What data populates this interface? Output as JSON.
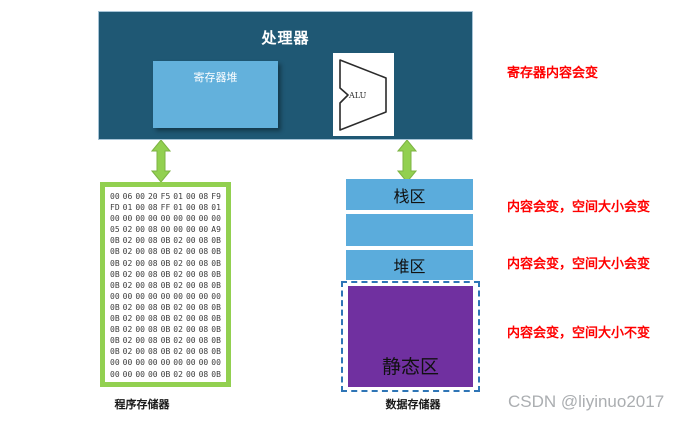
{
  "colors": {
    "processor_bg": "#1F5874",
    "register_bg": "#63B1DC",
    "memory_border_green": "#92D050",
    "arrow_green": "#92D050",
    "block_blue": "#5BACDC",
    "static_purple": "#7030A0",
    "dashed_border_blue": "#2E75B6",
    "annotation_red": "#FF0000",
    "watermark_gray": "#ABAEB1"
  },
  "processor": {
    "title": "处理器",
    "register_file_label": "寄存器堆",
    "alu_label": "ALU"
  },
  "program_memory": {
    "label": "程序存储器",
    "hex_rows": [
      "00 06 00 20 F5 01 00 08 F9",
      "FD 01 00 08 FF 01 00 08 01",
      "00 00 00 00 00 00 00 00 00",
      "05 02 00 08 00 00 00 00 A9",
      "0B 02 00 08 0B 02 00 08 0B",
      "0B 02 00 08 0B 02 00 08 0B",
      "0B 02 00 08 0B 02 00 08 0B",
      "0B 02 00 08 0B 02 00 08 0B",
      "0B 02 00 08 0B 02 00 08 0B",
      "00 00 00 00 00 00 00 00 00",
      "0B 02 00 08 0B 02 00 08 0B",
      "0B 02 00 08 0B 02 00 08 0B",
      "0B 02 00 08 0B 02 00 08 0B",
      "0B 02 00 08 0B 02 00 08 0B",
      "0B 02 00 08 0B 02 00 08 0B",
      "00 00 00 00 00 00 00 00 00",
      "00 00 00 00 0B 02 00 08 0B"
    ]
  },
  "data_memory": {
    "label": "数据存储器",
    "stack_label": "栈区",
    "heap_label": "堆区",
    "static_label": "静态区"
  },
  "annotations": {
    "register_note": "寄存器内容会变",
    "stack_note": "内容会变，空间大小会变",
    "heap_note": "内容会变，空间大小会变",
    "static_note": "内容会变，空间大小不变"
  },
  "watermark": "CSDN @liyinuo2017"
}
